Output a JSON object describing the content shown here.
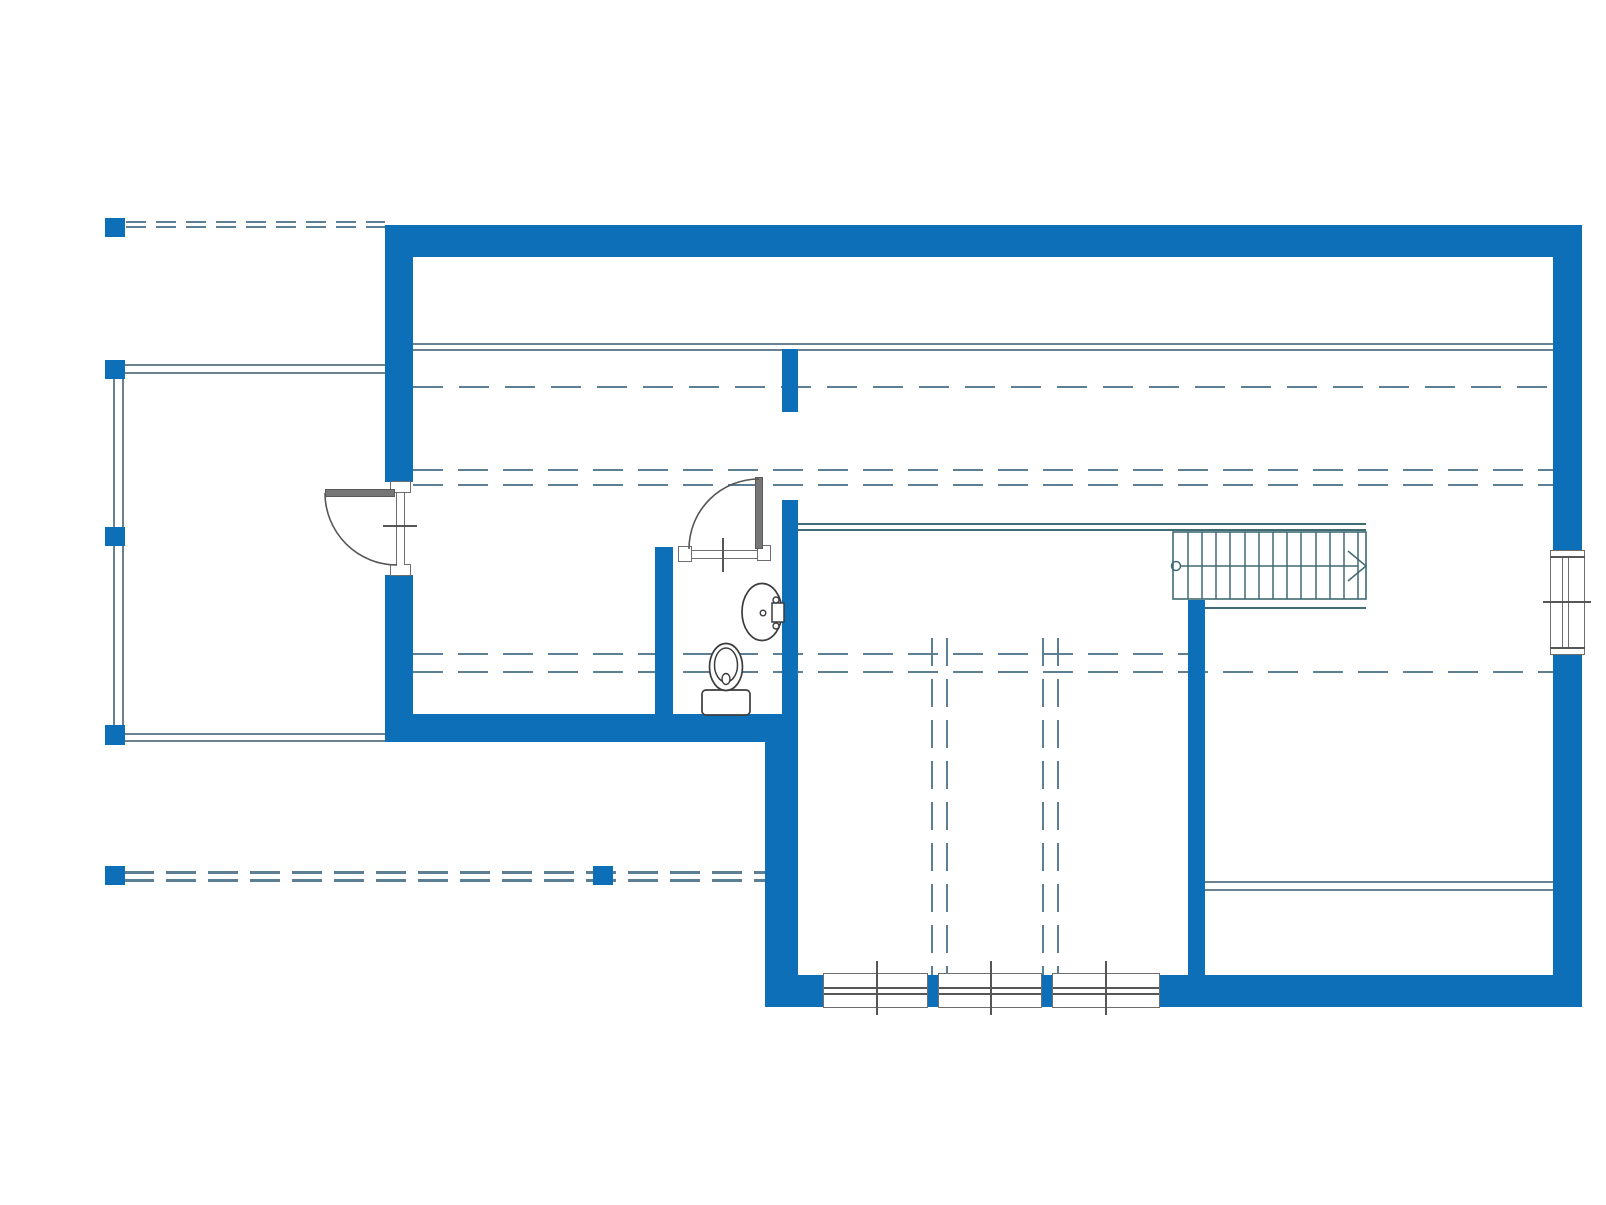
{
  "meta": {
    "canvas": {
      "w": 1606,
      "h": 1205
    }
  },
  "colors": {
    "wall": "#0c6fb8",
    "line": "#6a8191",
    "dash": "#5d7f95",
    "stair": "#3f6b72",
    "dark": "#565656",
    "frameBorder": "#6e6e6e",
    "panel": "#767676",
    "fixture": "#3c3c3c"
  },
  "layers": {
    "thin_lines": [
      {
        "name": "ceiling-break-line-upper",
        "o": "h",
        "x": 413,
        "y": 343,
        "len": 1140,
        "t": 2,
        "c": "line"
      },
      {
        "name": "ceiling-break-line-lower",
        "o": "h",
        "x": 413,
        "y": 349,
        "len": 1140,
        "t": 2,
        "c": "line"
      },
      {
        "name": "deck-top-edge-outer",
        "o": "h",
        "x": 112,
        "y": 364,
        "len": 273,
        "t": 2,
        "c": "line"
      },
      {
        "name": "deck-top-edge-inner",
        "o": "h",
        "x": 112,
        "y": 372,
        "len": 273,
        "t": 2,
        "c": "line"
      },
      {
        "name": "deck-left-edge-outer",
        "o": "v",
        "x": 113,
        "y": 364,
        "len": 378,
        "t": 2,
        "c": "line"
      },
      {
        "name": "deck-left-edge-inner",
        "o": "v",
        "x": 122,
        "y": 364,
        "len": 378,
        "t": 2,
        "c": "line"
      },
      {
        "name": "deck-bottom-edge-outer",
        "o": "h",
        "x": 105,
        "y": 733,
        "len": 280,
        "t": 2,
        "c": "line"
      },
      {
        "name": "deck-bottom-edge-inner",
        "o": "h",
        "x": 105,
        "y": 740,
        "len": 280,
        "t": 2,
        "c": "line"
      },
      {
        "name": "stair-landing-guard-outer",
        "o": "h",
        "x": 798,
        "y": 523,
        "len": 568,
        "t": 2,
        "c": "stair"
      },
      {
        "name": "stair-landing-guard-inner",
        "o": "h",
        "x": 798,
        "y": 529,
        "len": 568,
        "t": 2,
        "c": "stair"
      },
      {
        "name": "stair-lower-edge-line",
        "o": "h",
        "x": 1188,
        "y": 607,
        "len": 178,
        "t": 2,
        "c": "stair"
      },
      {
        "name": "right-room-divider-outer",
        "o": "h",
        "x": 1205,
        "y": 881,
        "len": 348,
        "t": 2,
        "c": "line"
      },
      {
        "name": "right-room-divider-inner",
        "o": "h",
        "x": 1205,
        "y": 889,
        "len": 348,
        "t": 2,
        "c": "line"
      }
    ],
    "dashed_lines": [
      {
        "name": "roof-overhang-dash-top-a",
        "o": "h",
        "x": 126,
        "y": 221,
        "len": 259,
        "t": 2,
        "dash": 20,
        "gap": 10
      },
      {
        "name": "roof-overhang-dash-top-b",
        "o": "h",
        "x": 126,
        "y": 226,
        "len": 259,
        "t": 2,
        "dash": 20,
        "gap": 10
      },
      {
        "name": "roof-edge-dash-single",
        "o": "h",
        "x": 413,
        "y": 386,
        "len": 1140,
        "t": 2,
        "dash": 30,
        "gap": 16
      },
      {
        "name": "headroom-dash-upper-a",
        "o": "h",
        "x": 413,
        "y": 469,
        "len": 1140,
        "t": 2,
        "dash": 30,
        "gap": 15
      },
      {
        "name": "headroom-dash-upper-b",
        "o": "h",
        "x": 413,
        "y": 484,
        "len": 1140,
        "t": 2,
        "dash": 30,
        "gap": 15
      },
      {
        "name": "headroom-dash-lower-a",
        "o": "h",
        "x": 413,
        "y": 653,
        "len": 775,
        "t": 2,
        "dash": 30,
        "gap": 15
      },
      {
        "name": "headroom-dash-lower-b",
        "o": "h",
        "x": 413,
        "y": 671,
        "len": 1140,
        "t": 2,
        "dash": 30,
        "gap": 15
      },
      {
        "name": "lower-terrace-dash-a",
        "o": "h",
        "x": 124,
        "y": 871,
        "len": 641,
        "t": 2.5,
        "dash": 30,
        "gap": 12
      },
      {
        "name": "lower-terrace-dash-b",
        "o": "h",
        "x": 124,
        "y": 879,
        "len": 641,
        "t": 2.5,
        "dash": 30,
        "gap": 12
      },
      {
        "name": "void-dash-vertical-a1",
        "o": "v",
        "x": 931,
        "y": 638,
        "len": 337,
        "t": 2,
        "dash": 28,
        "gap": 13
      },
      {
        "name": "void-dash-vertical-a2",
        "o": "v",
        "x": 946,
        "y": 638,
        "len": 337,
        "t": 2,
        "dash": 28,
        "gap": 13
      },
      {
        "name": "void-dash-vertical-b1",
        "o": "v",
        "x": 1042,
        "y": 638,
        "len": 337,
        "t": 2,
        "dash": 28,
        "gap": 13
      },
      {
        "name": "void-dash-vertical-b2",
        "o": "v",
        "x": 1057,
        "y": 638,
        "len": 337,
        "t": 2,
        "dash": 28,
        "gap": 13
      }
    ],
    "walls": [
      {
        "name": "wall-north",
        "x": 385,
        "y": 225,
        "w": 1197,
        "h": 32
      },
      {
        "name": "wall-west-upper",
        "x": 385,
        "y": 257,
        "w": 28,
        "h": 225
      },
      {
        "name": "wall-west-lower",
        "x": 385,
        "y": 575,
        "w": 28,
        "h": 139
      },
      {
        "name": "wall-south-band-left",
        "x": 385,
        "y": 714,
        "w": 413,
        "h": 28
      },
      {
        "name": "wall-east-upper",
        "x": 1553,
        "y": 257,
        "w": 29,
        "h": 293
      },
      {
        "name": "wall-east-lower",
        "x": 1553,
        "y": 655,
        "w": 29,
        "h": 352
      },
      {
        "name": "wall-bathroom-left",
        "x": 655,
        "y": 547,
        "w": 18,
        "h": 167
      },
      {
        "name": "wall-bathroom-right",
        "x": 782,
        "y": 500,
        "w": 16,
        "h": 214
      },
      {
        "name": "wall-stub-upper",
        "x": 782,
        "y": 349,
        "w": 16,
        "h": 63
      },
      {
        "name": "wall-mid-south",
        "x": 765,
        "y": 742,
        "w": 33,
        "h": 265
      },
      {
        "name": "wall-south",
        "x": 765,
        "y": 975,
        "w": 817,
        "h": 32
      },
      {
        "name": "wall-interior-bedroom",
        "x": 1188,
        "y": 600,
        "w": 17,
        "h": 375
      }
    ],
    "posts": [
      {
        "name": "deck-post-nw",
        "x": 105,
        "y": 218,
        "w": 20,
        "h": 19
      },
      {
        "name": "deck-post-top",
        "x": 105,
        "y": 360,
        "w": 20,
        "h": 19
      },
      {
        "name": "deck-post-mid",
        "x": 105,
        "y": 527,
        "w": 20,
        "h": 19
      },
      {
        "name": "deck-post-bottom",
        "x": 105,
        "y": 725,
        "w": 20,
        "h": 20
      },
      {
        "name": "terrace-post-sw",
        "x": 105,
        "y": 866,
        "w": 20,
        "h": 19
      },
      {
        "name": "terrace-post-mid",
        "x": 593,
        "y": 866,
        "w": 20,
        "h": 19
      }
    ],
    "white_frames": [
      {
        "name": "west-door-frame-top",
        "x": 390,
        "y": 481,
        "w": 21,
        "h": 12,
        "b": "all"
      },
      {
        "name": "west-door-frame-bottom",
        "x": 390,
        "y": 564,
        "w": 21,
        "h": 12,
        "b": "all"
      },
      {
        "name": "west-door-jamb",
        "x": 396,
        "y": 493,
        "w": 9,
        "h": 72,
        "b": "lr"
      },
      {
        "name": "bath-door-frame-left",
        "x": 678,
        "y": 546,
        "w": 14,
        "h": 16,
        "b": "all"
      },
      {
        "name": "bath-door-frame-right",
        "x": 757,
        "y": 545,
        "w": 14,
        "h": 16,
        "b": "all"
      },
      {
        "name": "bath-door-threshold",
        "x": 692,
        "y": 550,
        "w": 65,
        "h": 9,
        "b": "tb"
      },
      {
        "name": "east-window-box",
        "x": 1550,
        "y": 550,
        "w": 35,
        "h": 105,
        "b": "all"
      },
      {
        "name": "east-window-glass",
        "x": 1562,
        "y": 557,
        "w": 7,
        "h": 91,
        "b": "lr"
      },
      {
        "name": "south-window-1",
        "x": 823,
        "y": 973,
        "w": 105,
        "h": 35,
        "b": "all"
      },
      {
        "name": "south-window-2",
        "x": 938,
        "y": 973,
        "w": 104,
        "h": 35,
        "b": "all"
      },
      {
        "name": "south-window-3",
        "x": 1052,
        "y": 973,
        "w": 108,
        "h": 35,
        "b": "all"
      }
    ],
    "window_bars": [
      {
        "name": "east-window-frame-top",
        "x": 1550,
        "y": 556,
        "w": 35,
        "h": 1.6
      },
      {
        "name": "east-window-frame-bottom",
        "x": 1550,
        "y": 647,
        "w": 35,
        "h": 1.6
      },
      {
        "name": "east-window-center-tick",
        "x": 1543,
        "y": 601,
        "w": 48,
        "h": 1.8
      },
      {
        "name": "south-window-1-rail-a",
        "x": 824,
        "y": 987,
        "w": 103,
        "h": 1.6
      },
      {
        "name": "south-window-1-rail-b",
        "x": 824,
        "y": 993,
        "w": 103,
        "h": 1.6
      },
      {
        "name": "south-window-2-rail-a",
        "x": 939,
        "y": 987,
        "w": 102,
        "h": 1.6
      },
      {
        "name": "south-window-2-rail-b",
        "x": 939,
        "y": 993,
        "w": 102,
        "h": 1.6
      },
      {
        "name": "south-window-3-rail-a",
        "x": 1053,
        "y": 987,
        "w": 106,
        "h": 1.6
      },
      {
        "name": "south-window-3-rail-b",
        "x": 1053,
        "y": 993,
        "w": 106,
        "h": 1.6
      },
      {
        "name": "south-window-1-center-tick",
        "x": 876,
        "y": 961,
        "w": 1.8,
        "h": 54
      },
      {
        "name": "south-window-2-center-tick",
        "x": 990,
        "y": 961,
        "w": 1.8,
        "h": 54
      },
      {
        "name": "south-window-3-center-tick",
        "x": 1105,
        "y": 961,
        "w": 1.8,
        "h": 54
      },
      {
        "name": "west-door-center-tick",
        "x": 383,
        "y": 525,
        "w": 34,
        "h": 1.8
      },
      {
        "name": "bath-door-center-tick",
        "x": 722,
        "y": 538,
        "w": 1.8,
        "h": 34
      }
    ],
    "panels": [
      {
        "name": "west-door-leaf",
        "x": 325,
        "y": 489,
        "w": 70,
        "h": 8
      },
      {
        "name": "bath-door-leaf",
        "x": 755,
        "y": 477,
        "w": 8,
        "h": 72
      }
    ]
  },
  "svg_shapes": [
    {
      "name": "west-door-swing-arc",
      "type": "path",
      "attrs": {
        "d": "M325,493 A72,72 0 0 0 397,565",
        "stroke": "#565656",
        "stroke-width": "1.6",
        "fill": "none"
      }
    },
    {
      "name": "bath-door-swing-arc",
      "type": "path",
      "attrs": {
        "d": "M759,479 A70,70 0 0 0 689,549",
        "stroke": "#565656",
        "stroke-width": "1.6",
        "fill": "none"
      }
    },
    {
      "name": "stair-outline",
      "type": "rect",
      "attrs": {
        "x": "1173",
        "y": "532",
        "width": "193",
        "height": "67",
        "stroke": "#3f6b72",
        "stroke-width": "1.6",
        "fill": "none"
      }
    },
    {
      "name": "stair-tread",
      "type": "line",
      "attrs": {
        "x1": "1188",
        "y1": "532",
        "x2": "1188",
        "y2": "599",
        "stroke": "#3f6b72",
        "stroke-width": "1.5"
      }
    },
    {
      "name": "stair-tread",
      "type": "line",
      "attrs": {
        "x1": "1202",
        "y1": "532",
        "x2": "1202",
        "y2": "599",
        "stroke": "#3f6b72",
        "stroke-width": "1.5"
      }
    },
    {
      "name": "stair-tread",
      "type": "line",
      "attrs": {
        "x1": "1216",
        "y1": "532",
        "x2": "1216",
        "y2": "599",
        "stroke": "#3f6b72",
        "stroke-width": "1.5"
      }
    },
    {
      "name": "stair-tread",
      "type": "line",
      "attrs": {
        "x1": "1230",
        "y1": "532",
        "x2": "1230",
        "y2": "599",
        "stroke": "#3f6b72",
        "stroke-width": "1.5"
      }
    },
    {
      "name": "stair-tread",
      "type": "line",
      "attrs": {
        "x1": "1245",
        "y1": "532",
        "x2": "1245",
        "y2": "599",
        "stroke": "#3f6b72",
        "stroke-width": "1.5"
      }
    },
    {
      "name": "stair-tread",
      "type": "line",
      "attrs": {
        "x1": "1259",
        "y1": "532",
        "x2": "1259",
        "y2": "599",
        "stroke": "#3f6b72",
        "stroke-width": "1.5"
      }
    },
    {
      "name": "stair-tread",
      "type": "line",
      "attrs": {
        "x1": "1273",
        "y1": "532",
        "x2": "1273",
        "y2": "599",
        "stroke": "#3f6b72",
        "stroke-width": "1.5"
      }
    },
    {
      "name": "stair-tread",
      "type": "line",
      "attrs": {
        "x1": "1287",
        "y1": "532",
        "x2": "1287",
        "y2": "599",
        "stroke": "#3f6b72",
        "stroke-width": "1.5"
      }
    },
    {
      "name": "stair-tread",
      "type": "line",
      "attrs": {
        "x1": "1301",
        "y1": "532",
        "x2": "1301",
        "y2": "599",
        "stroke": "#3f6b72",
        "stroke-width": "1.5"
      }
    },
    {
      "name": "stair-tread",
      "type": "line",
      "attrs": {
        "x1": "1316",
        "y1": "532",
        "x2": "1316",
        "y2": "599",
        "stroke": "#3f6b72",
        "stroke-width": "1.5"
      }
    },
    {
      "name": "stair-tread",
      "type": "line",
      "attrs": {
        "x1": "1330",
        "y1": "532",
        "x2": "1330",
        "y2": "599",
        "stroke": "#3f6b72",
        "stroke-width": "1.5"
      }
    },
    {
      "name": "stair-tread",
      "type": "line",
      "attrs": {
        "x1": "1344",
        "y1": "532",
        "x2": "1344",
        "y2": "599",
        "stroke": "#3f6b72",
        "stroke-width": "1.5"
      }
    },
    {
      "name": "stair-tread",
      "type": "line",
      "attrs": {
        "x1": "1358",
        "y1": "532",
        "x2": "1358",
        "y2": "599",
        "stroke": "#3f6b72",
        "stroke-width": "1.5"
      }
    },
    {
      "name": "stair-direction-line",
      "type": "line",
      "attrs": {
        "x1": "1180",
        "y1": "566",
        "x2": "1358",
        "y2": "566",
        "stroke": "#3f6b72",
        "stroke-width": "1.5"
      }
    },
    {
      "name": "stair-direction-start-circle",
      "type": "circle",
      "attrs": {
        "cx": "1176",
        "cy": "566",
        "r": "4.5",
        "stroke": "#3f6b72",
        "stroke-width": "1.5",
        "fill": "none"
      }
    },
    {
      "name": "stair-direction-arrow",
      "type": "polyline",
      "attrs": {
        "points": "1348,551 1366,566 1348,581",
        "stroke": "#3f6b72",
        "stroke-width": "1.5",
        "fill": "none"
      }
    },
    {
      "name": "toilet-tank",
      "type": "rect",
      "attrs": {
        "x": "702",
        "y": "690",
        "width": "48",
        "height": "25",
        "rx": "4",
        "stroke": "#3c3c3c",
        "stroke-width": "1.7",
        "fill": "#ffffff"
      }
    },
    {
      "name": "toilet-bowl-outer",
      "type": "ellipse",
      "attrs": {
        "cx": "726",
        "cy": "667",
        "rx": "16.5",
        "ry": "23.5",
        "stroke": "#3c3c3c",
        "stroke-width": "1.7",
        "fill": "#ffffff"
      }
    },
    {
      "name": "toilet-bowl-inner",
      "type": "ellipse",
      "attrs": {
        "cx": "726",
        "cy": "665",
        "rx": "11.5",
        "ry": "17",
        "stroke": "#3c3c3c",
        "stroke-width": "1.5",
        "fill": "none"
      }
    },
    {
      "name": "toilet-drain",
      "type": "ellipse",
      "attrs": {
        "cx": "726",
        "cy": "679",
        "rx": "4",
        "ry": "5.5",
        "stroke": "#3c3c3c",
        "stroke-width": "1.4",
        "fill": "#ffffff"
      }
    },
    {
      "name": "sink-bowl",
      "type": "ellipse",
      "attrs": {
        "cx": "762",
        "cy": "612",
        "rx": "20",
        "ry": "28.5",
        "stroke": "#3c3c3c",
        "stroke-width": "1.7",
        "fill": "#ffffff"
      }
    },
    {
      "name": "sink-backsplash-box",
      "type": "rect",
      "attrs": {
        "x": "772",
        "y": "603",
        "width": "12",
        "height": "19",
        "stroke": "#3c3c3c",
        "stroke-width": "1.5",
        "fill": "#ffffff"
      }
    },
    {
      "name": "sink-tap-knob-top",
      "type": "circle",
      "attrs": {
        "cx": "776",
        "cy": "600",
        "r": "3",
        "stroke": "#3c3c3c",
        "stroke-width": "1.4",
        "fill": "#ffffff"
      }
    },
    {
      "name": "sink-tap-knob-bottom",
      "type": "circle",
      "attrs": {
        "cx": "776",
        "cy": "626",
        "r": "3",
        "stroke": "#3c3c3c",
        "stroke-width": "1.4",
        "fill": "#ffffff"
      }
    },
    {
      "name": "sink-faucet",
      "type": "circle",
      "attrs": {
        "cx": "763",
        "cy": "613",
        "r": "2.8",
        "stroke": "#3c3c3c",
        "stroke-width": "1.4",
        "fill": "#ffffff"
      }
    }
  ]
}
